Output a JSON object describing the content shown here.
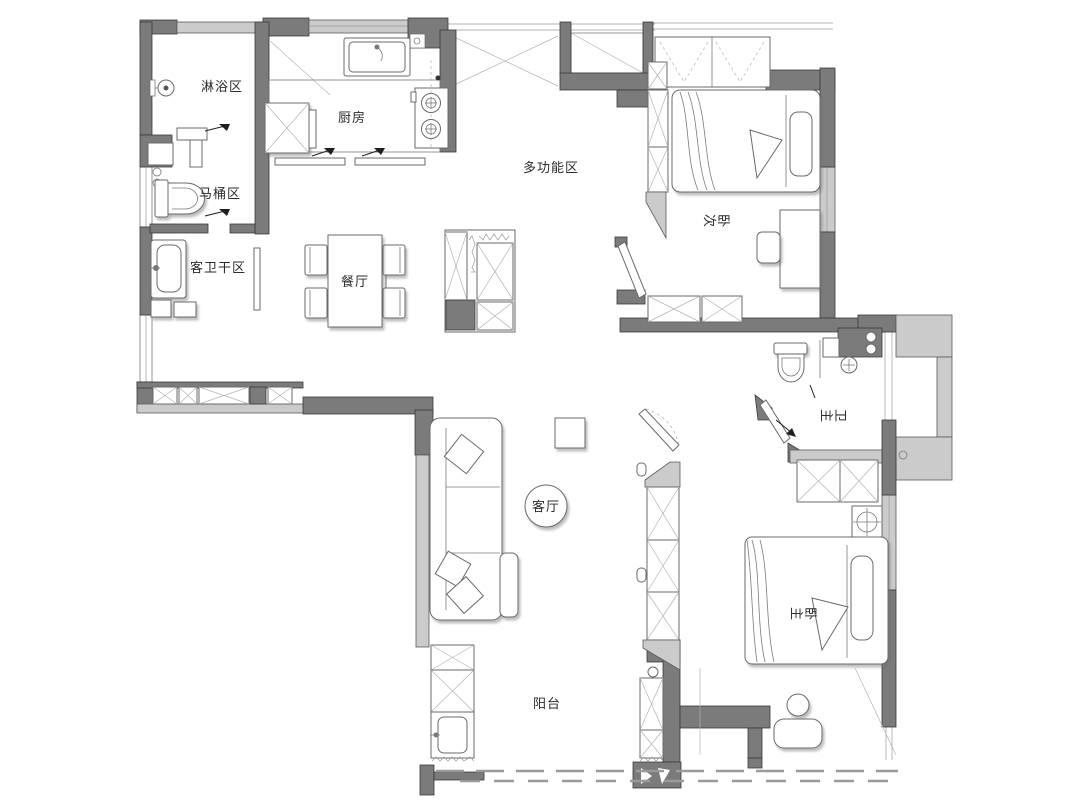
{
  "plan": {
    "rooms": {
      "shower": {
        "label": "淋浴区"
      },
      "toilet": {
        "label": "马桶区"
      },
      "guest_bath_dry": {
        "label": "客卫干区"
      },
      "kitchen": {
        "label": "厨房"
      },
      "dining": {
        "label": "餐厅"
      },
      "multifunction": {
        "label": "多功能区"
      },
      "second_bedroom": {
        "label": "次卧"
      },
      "master_bath": {
        "label": "主卫"
      },
      "living": {
        "label": "客厅"
      },
      "master_bedroom": {
        "label": "主卧"
      },
      "balcony": {
        "label": "阳台"
      }
    },
    "colors": {
      "wall_dark": "#7b7b7b",
      "wall_light": "#cbcbcb",
      "furniture_line": "#6a6a6a",
      "background": "#ffffff",
      "label_text": "#2b2b2b"
    }
  }
}
